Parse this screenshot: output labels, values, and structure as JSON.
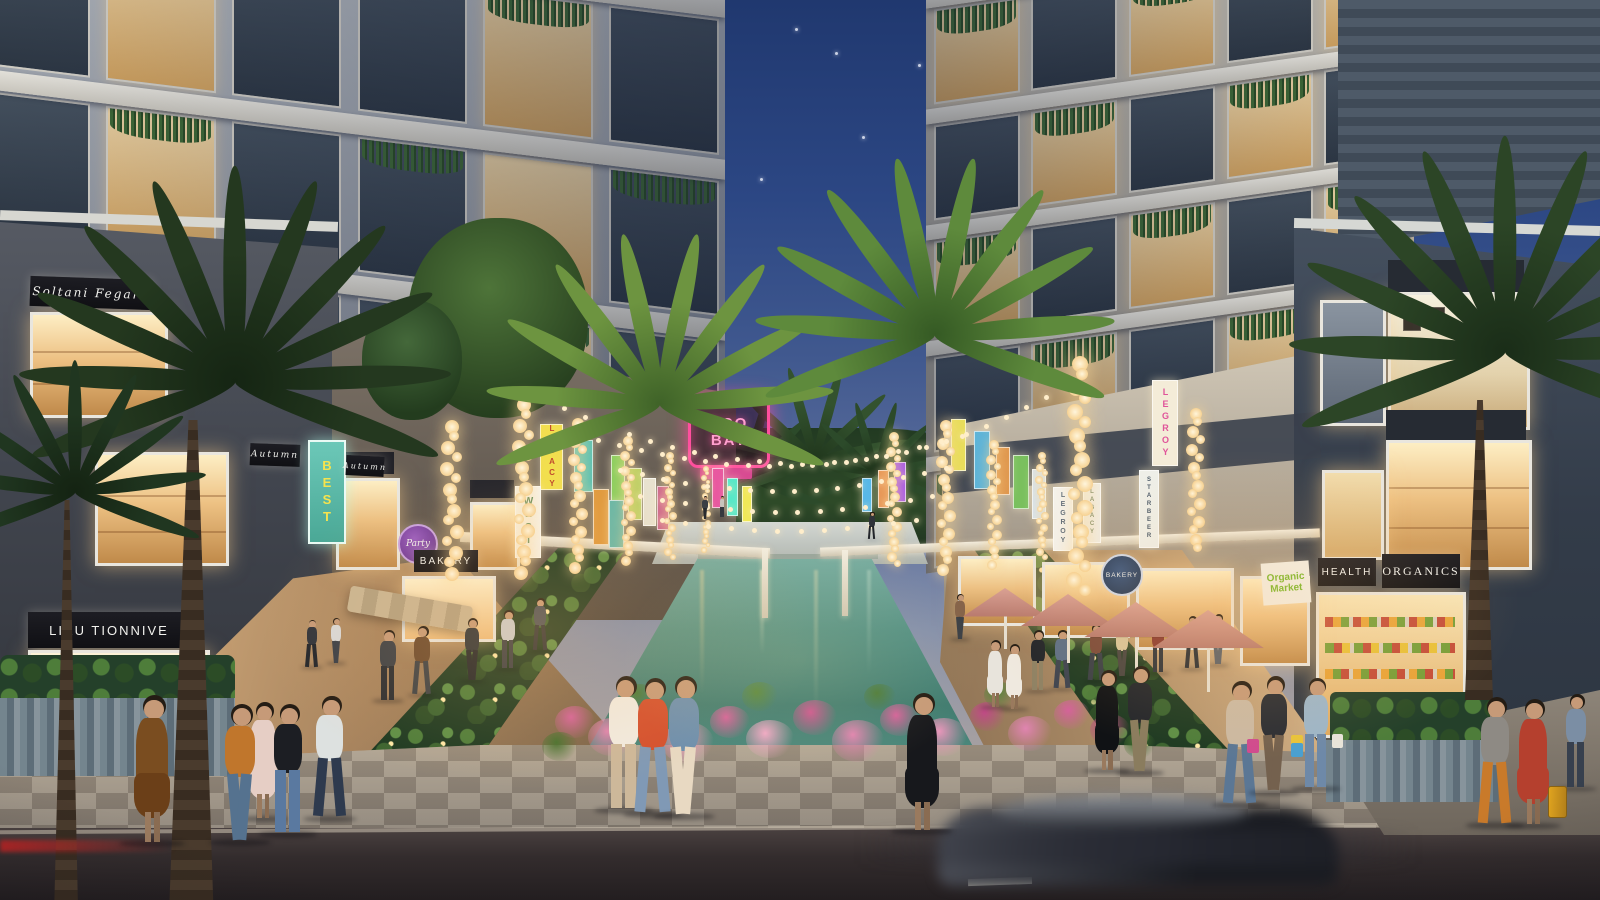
{
  "signs": {
    "soltani": "Soltani Fegaro",
    "autumn_a": "Autumn",
    "autumn_b": "Autumn",
    "best": "BEST",
    "tionnive": "LIXU TIONNIVE",
    "bakery": "BAKERY",
    "party": "Party",
    "eco_line1": "ECO",
    "eco_line2": "BAY",
    "health": "HEALTH",
    "organics": "ORGANICS",
    "organic_l1": "Organic",
    "organic_l2": "Market",
    "bakery_badge": "BAKERY"
  },
  "colors": {
    "sky_top": "#20386f",
    "water": "#4e8d7f",
    "umbrella": "#c98b80",
    "flower_pink": "#e084b0",
    "neon_pink": "#ff4f9e",
    "bulb_warm": "#ffe9bd"
  },
  "scene": {
    "stars": [
      {
        "x": 795,
        "y": 28
      },
      {
        "x": 918,
        "y": 64
      },
      {
        "x": 706,
        "y": 98
      },
      {
        "x": 862,
        "y": 136
      },
      {
        "x": 760,
        "y": 178
      },
      {
        "x": 835,
        "y": 52
      }
    ],
    "grids": {
      "left_tower": {
        "left": -30,
        "top": -95,
        "w": 755,
        "h": 485,
        "skew": 7,
        "origin": "0 0",
        "rows": 3,
        "cols": 6,
        "slab": 20,
        "base1": "#b7bcc2",
        "base2": "#878d98"
      },
      "right_tower": {
        "left": 926,
        "top": -75,
        "w": 488,
        "h": 580,
        "skew": -8,
        "origin": "100% 0",
        "rows": 5,
        "cols": 5,
        "slab": 15,
        "base1": "#c6c2b8",
        "base2": "#948f86"
      }
    },
    "left_banners": [
      {
        "x": 540,
        "y": 424,
        "w": 21,
        "h": 64,
        "bg": "#f2df4e",
        "text": "LEGACY",
        "tc": "#c04a2e",
        "fs": 8
      },
      {
        "x": 515,
        "y": 486,
        "w": 24,
        "h": 70,
        "bg": "#f7f5ee",
        "text": "WEST",
        "tc": "#3f7a4e",
        "fs": 10
      },
      {
        "x": 574,
        "y": 440,
        "w": 17,
        "h": 50,
        "bg": "#59c2b4"
      },
      {
        "x": 593,
        "y": 489,
        "w": 14,
        "h": 54,
        "bg": "#e09a3e"
      },
      {
        "x": 611,
        "y": 455,
        "w": 12,
        "h": 44,
        "bg": "#8ccf5e"
      },
      {
        "x": 609,
        "y": 500,
        "w": 13,
        "h": 46,
        "bg": "#68b8a8"
      },
      {
        "x": 628,
        "y": 468,
        "w": 12,
        "h": 50,
        "bg": "#b8cf5e"
      },
      {
        "x": 643,
        "y": 478,
        "w": 11,
        "h": 46,
        "bg": "#e8e2d0"
      },
      {
        "x": 657,
        "y": 486,
        "w": 10,
        "h": 42,
        "bg": "#cf6a8e"
      },
      {
        "x": 712,
        "y": 468,
        "w": 10,
        "h": 38,
        "bg": "#e858a0"
      },
      {
        "x": 727,
        "y": 478,
        "w": 9,
        "h": 36,
        "bg": "#58e8c8"
      },
      {
        "x": 742,
        "y": 486,
        "w": 8,
        "h": 34,
        "bg": "#f0e858"
      }
    ],
    "right_banners": [
      {
        "x": 1152,
        "y": 380,
        "w": 24,
        "h": 84,
        "bg": "#f4ecd8",
        "text": "LEGROY",
        "tc": "#e0549a",
        "fs": 9
      },
      {
        "x": 1139,
        "y": 470,
        "w": 18,
        "h": 76,
        "bg": "#eef0ea",
        "text": "STARBEER",
        "tc": "#4a5a6a",
        "fs": 6
      },
      {
        "x": 1083,
        "y": 483,
        "w": 16,
        "h": 58,
        "bg": "#f0eee6",
        "text": "LAGACY",
        "tc": "#7a8a6a",
        "fs": 6
      },
      {
        "x": 1053,
        "y": 487,
        "w": 18,
        "h": 62,
        "bg": "#f4f2ec",
        "text": "LEGROY",
        "tc": "#5a6a7a",
        "fs": 7
      },
      {
        "x": 1013,
        "y": 455,
        "w": 14,
        "h": 52,
        "bg": "#7ac05e"
      },
      {
        "x": 1032,
        "y": 469,
        "w": 12,
        "h": 48,
        "bg": "#d8e4ee"
      },
      {
        "x": 974,
        "y": 431,
        "w": 14,
        "h": 56,
        "bg": "#5eb4d8"
      },
      {
        "x": 951,
        "y": 419,
        "w": 13,
        "h": 50,
        "bg": "#e8de5a"
      },
      {
        "x": 996,
        "y": 447,
        "w": 12,
        "h": 46,
        "bg": "#e0984e"
      },
      {
        "x": 878,
        "y": 470,
        "w": 9,
        "h": 36,
        "bg": "#e89858"
      },
      {
        "x": 894,
        "y": 462,
        "w": 10,
        "h": 38,
        "bg": "#a858e8"
      },
      {
        "x": 862,
        "y": 478,
        "w": 8,
        "h": 32,
        "bg": "#58b8e8"
      }
    ],
    "light_columns": [
      {
        "x": 452,
        "y1": 420,
        "y2": 586,
        "r": 7
      },
      {
        "x": 524,
        "y1": 398,
        "y2": 582,
        "r": 7
      },
      {
        "x": 578,
        "y1": 418,
        "y2": 574,
        "r": 6
      },
      {
        "x": 628,
        "y1": 436,
        "y2": 568,
        "r": 5
      },
      {
        "x": 670,
        "y1": 452,
        "y2": 560,
        "r": 4
      },
      {
        "x": 706,
        "y1": 466,
        "y2": 552,
        "r": 3
      },
      {
        "x": 894,
        "y1": 432,
        "y2": 570,
        "r": 5
      },
      {
        "x": 946,
        "y1": 420,
        "y2": 576,
        "r": 6
      },
      {
        "x": 994,
        "y1": 440,
        "y2": 568,
        "r": 5
      },
      {
        "x": 1042,
        "y1": 452,
        "y2": 560,
        "r": 4
      },
      {
        "x": 1080,
        "y1": 356,
        "y2": 596,
        "r": 8
      },
      {
        "x": 1196,
        "y1": 408,
        "y2": 560,
        "r": 6
      }
    ],
    "string_rows": [
      {
        "x1": 596,
        "y1": 438,
        "x2": 960,
        "y2": 434,
        "sag": 28,
        "n": 17
      },
      {
        "x1": 618,
        "y1": 468,
        "x2": 944,
        "y2": 466,
        "sag": 22,
        "n": 15
      },
      {
        "x1": 638,
        "y1": 494,
        "x2": 930,
        "y2": 494,
        "sag": 16,
        "n": 13
      },
      {
        "x1": 660,
        "y1": 518,
        "x2": 914,
        "y2": 518,
        "sag": 11,
        "n": 11
      },
      {
        "x1": 540,
        "y1": 396,
        "x2": 800,
        "y2": 462,
        "sag": 16,
        "n": 12
      },
      {
        "x1": 1064,
        "y1": 384,
        "x2": 824,
        "y2": 462,
        "sag": 16,
        "n": 12
      }
    ],
    "umbrellas": [
      {
        "x": 1005,
        "y": 588,
        "w": 84
      },
      {
        "x": 1068,
        "y": 594,
        "w": 94
      },
      {
        "x": 1136,
        "y": 602,
        "w": 104
      },
      {
        "x": 1208,
        "y": 610,
        "w": 112
      }
    ],
    "palms": [
      {
        "x": 235,
        "y": 370,
        "s": 1.8,
        "c1": "#24381f",
        "c2": "#152513",
        "n": 11,
        "z": 48
      },
      {
        "x": 75,
        "y": 485,
        "s": 1.1,
        "c1": "#203620",
        "c2": "#142312",
        "n": 9,
        "z": 48
      },
      {
        "x": 660,
        "y": 395,
        "s": 1.45,
        "c1": "#6d9440",
        "c2": "#3f6328",
        "n": 10,
        "z": 52
      },
      {
        "x": 935,
        "y": 325,
        "s": 1.5,
        "c1": "#5e8a3c",
        "c2": "#355a24",
        "n": 10,
        "z": 52
      },
      {
        "x": 1505,
        "y": 340,
        "s": 1.8,
        "c1": "#2c4526",
        "c2": "#1a2d18",
        "n": 11,
        "z": 48
      },
      {
        "x": 745,
        "y": 472,
        "s": 0.7,
        "c1": "#2c4a2a",
        "c2": "#1c3018",
        "n": 8,
        "z": 9
      },
      {
        "x": 815,
        "y": 455,
        "s": 0.8,
        "c1": "#33522e",
        "c2": "#20361c",
        "n": 8,
        "z": 9
      },
      {
        "x": 876,
        "y": 470,
        "s": 0.62,
        "c1": "#2c4a2a",
        "c2": "#1c3018",
        "n": 8,
        "z": 9
      }
    ],
    "trunks": [
      {
        "x": 165,
        "y": 420,
        "w": 56,
        "h": 480,
        "z": 47
      },
      {
        "x": 52,
        "y": 500,
        "w": 30,
        "h": 400,
        "z": 47
      },
      {
        "x": 1462,
        "y": 400,
        "w": 36,
        "h": 300,
        "z": 47
      }
    ],
    "flowers": [
      {
        "x": 575,
        "y": 726,
        "r": 20,
        "c": "#d4629a"
      },
      {
        "x": 612,
        "y": 742,
        "r": 24,
        "c": "#e084b0"
      },
      {
        "x": 650,
        "y": 720,
        "r": 18,
        "c": "#c04a86"
      },
      {
        "x": 688,
        "y": 748,
        "r": 26,
        "c": "#e896ba"
      },
      {
        "x": 730,
        "y": 726,
        "r": 20,
        "c": "#d4629a"
      },
      {
        "x": 770,
        "y": 744,
        "r": 24,
        "c": "#f0a8c6"
      },
      {
        "x": 815,
        "y": 722,
        "r": 22,
        "c": "#cc5690"
      },
      {
        "x": 858,
        "y": 746,
        "r": 26,
        "c": "#e084b0"
      },
      {
        "x": 900,
        "y": 724,
        "r": 20,
        "c": "#d4629a"
      },
      {
        "x": 944,
        "y": 742,
        "r": 24,
        "c": "#e896ba"
      },
      {
        "x": 988,
        "y": 720,
        "r": 18,
        "c": "#c04a86"
      },
      {
        "x": 1030,
        "y": 738,
        "r": 22,
        "c": "#e084b0"
      },
      {
        "x": 1072,
        "y": 718,
        "r": 18,
        "c": "#d4629a"
      },
      {
        "x": 1110,
        "y": 734,
        "r": 20,
        "c": "#ba4a80"
      },
      {
        "x": 640,
        "y": 700,
        "r": 16,
        "c": "#4a7a38"
      },
      {
        "x": 760,
        "y": 700,
        "r": 18,
        "c": "#55863c"
      },
      {
        "x": 880,
        "y": 700,
        "r": 16,
        "c": "#4a7a38"
      },
      {
        "x": 1000,
        "y": 698,
        "r": 16,
        "c": "#55863c"
      },
      {
        "x": 1100,
        "y": 700,
        "r": 14,
        "c": "#4a7a38"
      },
      {
        "x": 560,
        "y": 750,
        "r": 18,
        "c": "#44702f"
      },
      {
        "x": 1140,
        "y": 748,
        "r": 16,
        "c": "#44702f"
      }
    ],
    "water_streaks": [
      {
        "x": 80,
        "h": 95,
        "c": "#ffe9b8",
        "o": 0.5
      },
      {
        "x": 148,
        "h": 125,
        "c": "#ffdf9e",
        "o": 0.4
      },
      {
        "x": 208,
        "h": 85,
        "c": "#fff4d0",
        "o": 0.55
      },
      {
        "x": 262,
        "h": 145,
        "c": "#ffe9b8",
        "o": 0.35
      },
      {
        "x": 315,
        "h": 105,
        "c": "#e8f4e0",
        "o": 0.3
      },
      {
        "x": 360,
        "h": 75,
        "c": "#ffefc4",
        "o": 0.45
      }
    ],
    "people": [
      {
        "x": 152,
        "y": 845,
        "h": 150,
        "top": "#7a4d20",
        "bottom": "#6b3f18",
        "dress": true
      },
      {
        "x": 263,
        "y": 820,
        "h": 118,
        "top": "#e6cec5",
        "bottom": "#e6cec5",
        "dress": true
      },
      {
        "x": 330,
        "y": 820,
        "h": 124,
        "top": "#dde1e0",
        "bottom": "#2e3a4e"
      },
      {
        "x": 240,
        "y": 844,
        "h": 140,
        "top": "#c0762c",
        "bottom": "#55728f"
      },
      {
        "x": 288,
        "y": 836,
        "h": 132,
        "top": "#1c1e23",
        "bottom": "#5a79a0"
      },
      {
        "x": 312,
        "y": 668,
        "h": 48,
        "top": "#30343c",
        "bottom": "#23262c"
      },
      {
        "x": 336,
        "y": 664,
        "h": 46,
        "top": "#d8d8d8",
        "bottom": "#3a3f48"
      },
      {
        "x": 624,
        "y": 812,
        "h": 136,
        "top": "#f1ebe1",
        "bottom": "#cdb89a"
      },
      {
        "x": 653,
        "y": 816,
        "h": 138,
        "top": "#d4502e",
        "bottom": "#8099b5"
      },
      {
        "x": 684,
        "y": 818,
        "h": 142,
        "top": "#6d8fae",
        "bottom": "#e8d9c2"
      },
      {
        "x": 922,
        "y": 833,
        "h": 140,
        "top": "#17181c",
        "bottom": "#17181c",
        "dress": true
      },
      {
        "x": 1107,
        "y": 772,
        "h": 102,
        "top": "#101215",
        "bottom": "#101215",
        "dress": true
      },
      {
        "x": 1140,
        "y": 774,
        "h": 108,
        "top": "#23262b",
        "bottom": "#8a7c5e"
      },
      {
        "x": 1038,
        "y": 692,
        "h": 62,
        "top": "#22252a",
        "bottom": "#8f8264"
      },
      {
        "x": 1062,
        "y": 690,
        "h": 60,
        "top": "#5d6f86",
        "bottom": "#3e4450"
      },
      {
        "x": 995,
        "y": 708,
        "h": 68,
        "top": "#e8e4dc",
        "bottom": "#e8e4dc",
        "dress": true
      },
      {
        "x": 1014,
        "y": 710,
        "h": 66,
        "top": "#efe9df",
        "bottom": "#efe9df",
        "dress": true
      },
      {
        "x": 1240,
        "y": 806,
        "h": 125,
        "top": "#cbb9a2",
        "bottom": "#5b7795"
      },
      {
        "x": 1274,
        "y": 794,
        "h": 118,
        "top": "#2a2d33",
        "bottom": "#74614e",
        "bags": [
          "#e8c33a",
          "#d04a8e",
          "#4aa0d0"
        ]
      },
      {
        "x": 1316,
        "y": 790,
        "h": 112,
        "top": "#9db6c8",
        "bottom": "#6e89a8",
        "bags": [
          "#e8e4da"
        ]
      },
      {
        "x": 1495,
        "y": 827,
        "h": 130,
        "top": "#8e8a84",
        "bottom": "#c97a2a"
      },
      {
        "x": 1533,
        "y": 827,
        "h": 128,
        "top": "#b5402e",
        "bottom": "#b5402e",
        "dress": true
      },
      {
        "x": 1576,
        "y": 790,
        "h": 96,
        "top": "#7b8ea4",
        "bottom": "#37404e"
      },
      {
        "x": 1096,
        "y": 682,
        "h": 58,
        "top": "#7a4a3a",
        "bottom": "#3a3f46"
      },
      {
        "x": 1122,
        "y": 678,
        "h": 56,
        "top": "#d8c49a",
        "bottom": "#4a4540"
      },
      {
        "x": 1158,
        "y": 674,
        "h": 55,
        "top": "#8a3a30",
        "bottom": "#30343a"
      },
      {
        "x": 1192,
        "y": 670,
        "h": 54,
        "top": "#3f5a40",
        "bottom": "#2a2e34"
      },
      {
        "x": 1218,
        "y": 666,
        "h": 52,
        "top": "#c0c4c8",
        "bottom": "#5a6068"
      },
      {
        "x": 388,
        "y": 702,
        "h": 72,
        "top": "#3c4046",
        "bottom": "#2a2d32"
      },
      {
        "x": 422,
        "y": 696,
        "h": 70,
        "top": "#6b4a2e",
        "bottom": "#3e4246"
      },
      {
        "x": 472,
        "y": 682,
        "h": 64,
        "top": "#2e3338",
        "bottom": "#23262a"
      },
      {
        "x": 508,
        "y": 670,
        "h": 60,
        "top": "#c8ccd0",
        "bottom": "#3a3e44"
      },
      {
        "x": 540,
        "y": 652,
        "h": 54,
        "top": "#4a5058",
        "bottom": "#2e3236"
      },
      {
        "x": 705,
        "y": 520,
        "h": 24,
        "top": "#3a3e44",
        "bottom": "#26292e"
      },
      {
        "x": 722,
        "y": 518,
        "h": 22,
        "top": "#c8c4bc",
        "bottom": "#34383e"
      },
      {
        "x": 872,
        "y": 540,
        "h": 28,
        "top": "#30343a",
        "bottom": "#22252a"
      },
      {
        "x": 960,
        "y": 640,
        "h": 46,
        "top": "#86644a",
        "bottom": "#3c4046"
      }
    ],
    "suitcase": {
      "x": 1548,
      "y": 786,
      "w": 17,
      "h": 30,
      "c": "#e0a41f"
    }
  }
}
